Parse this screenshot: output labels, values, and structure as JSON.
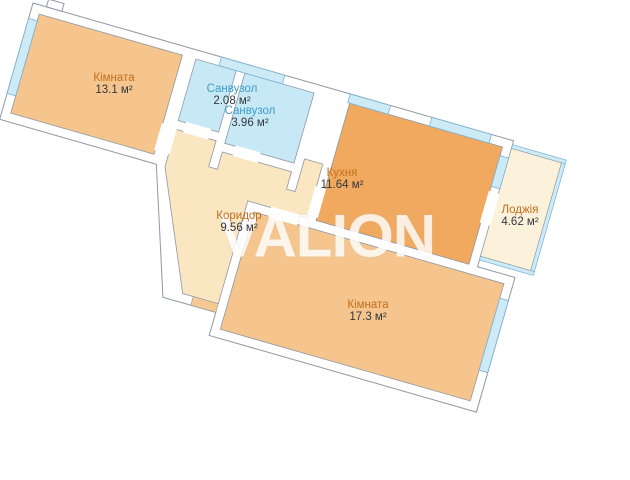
{
  "watermark": "VALION",
  "rooms": [
    {
      "name": "Кімната",
      "area": "13.1 м²"
    },
    {
      "name": "Санвузол",
      "area": "2.08 м²"
    },
    {
      "name": "Санвузол",
      "area": "3.96 м²"
    },
    {
      "name": "Кухня",
      "area": "11.64 м²"
    },
    {
      "name": "Лоджія",
      "area": "4.62 м²"
    },
    {
      "name": "Коридор",
      "area": "9.56 м²"
    },
    {
      "name": "Кімната",
      "area": "17.3 м²"
    }
  ],
  "colors": {
    "room_fill": "#f5c58d",
    "kitchen_fill": "#f0a95e",
    "bath_fill": "#c7e9f5",
    "corridor_fill": "#fbe6c2",
    "loggia_fill": "#fcf1da",
    "window_fill": "#cdeaf7",
    "window_stroke": "#79b2d2",
    "wall_stroke": "#8f98a2",
    "entry_fill": "#f6c993",
    "label_orange": "#c1701e",
    "label_blue": "#3e9cc9",
    "label_dark": "#33383e",
    "watermark_color": "#ffffff"
  }
}
